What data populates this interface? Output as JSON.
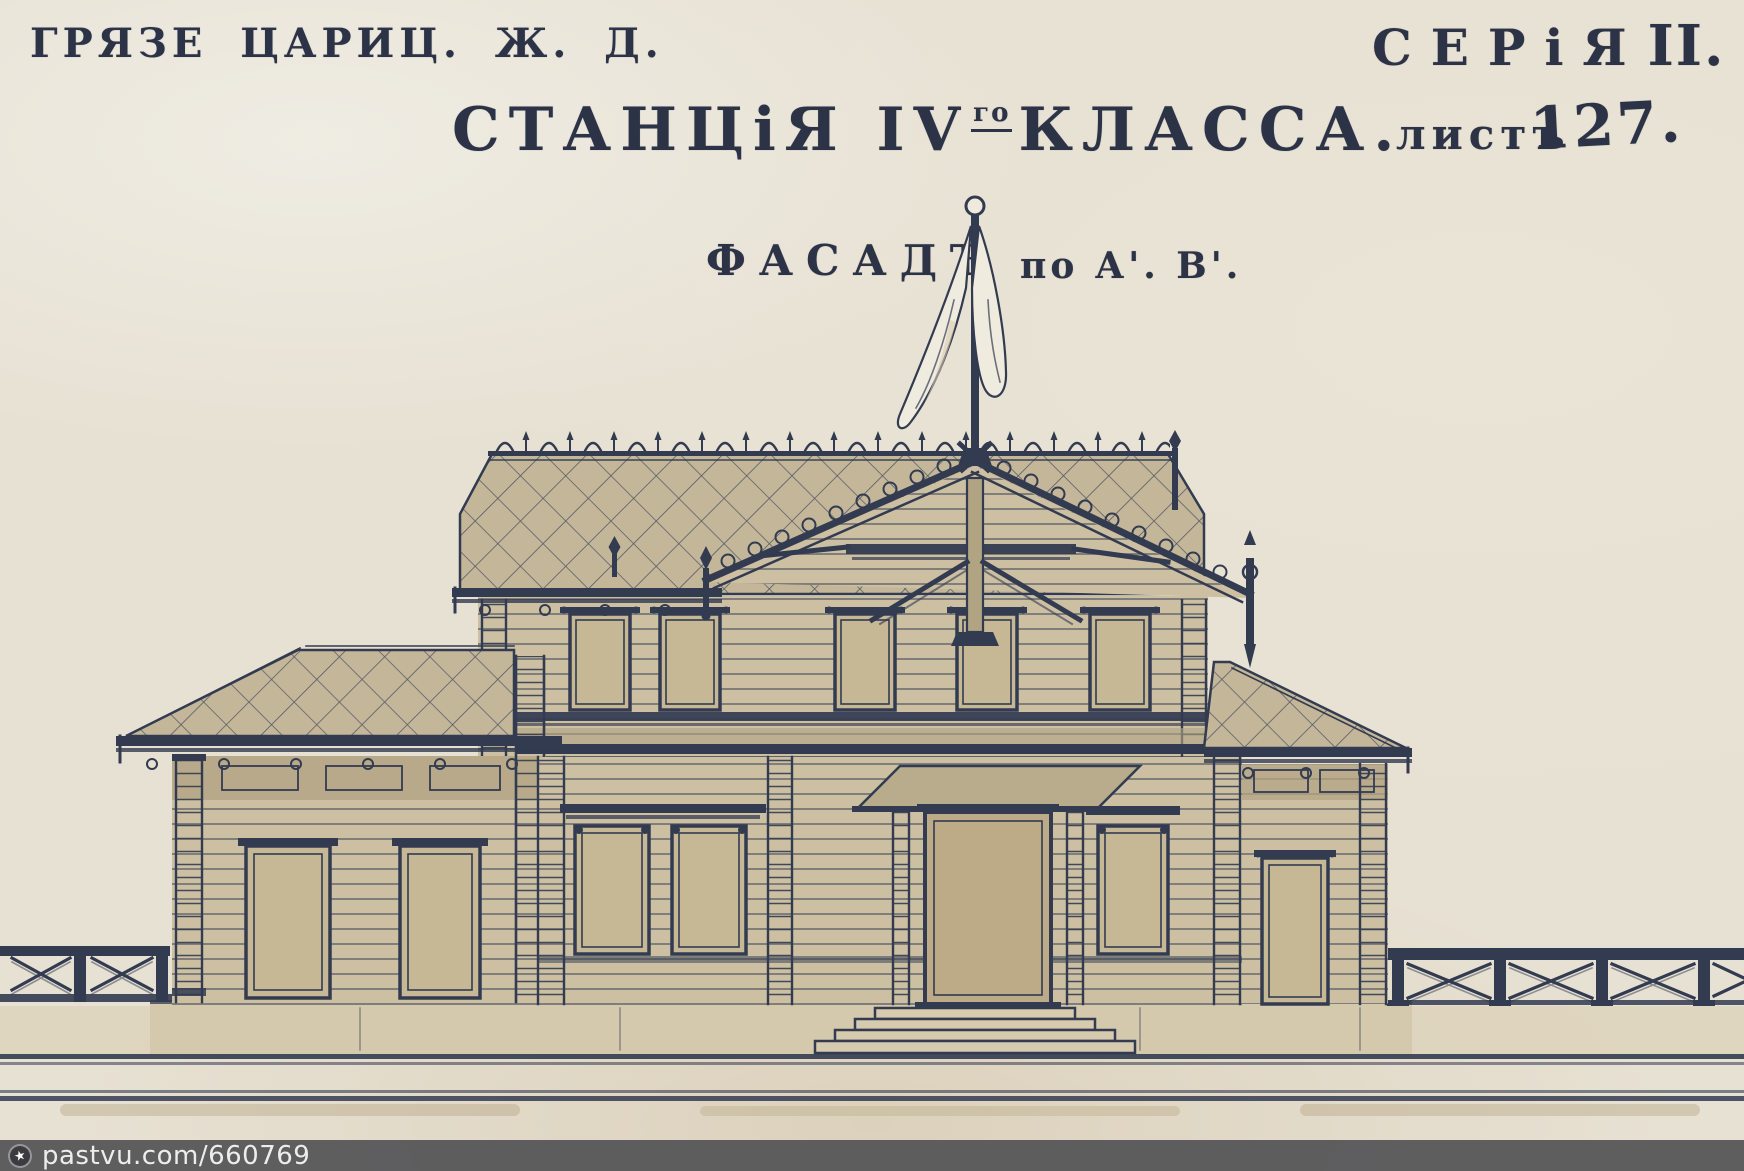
{
  "header": {
    "railway": "ГРЯЗЕ ЦАРИЦ. Ж. Д.",
    "series_word": "СЕРіЯ",
    "series_numeral": "II.",
    "title_station": "СТАНЦіЯ IV",
    "title_superscript": "го",
    "title_class": "КЛАССА.",
    "sheet_word": "листъ",
    "sheet_number": "127."
  },
  "caption": {
    "facade": "ФАСАДЪ",
    "axis": "по А'. В'."
  },
  "watermark": {
    "text": "pastvu.com/660769",
    "icon": "star-circle-icon",
    "star_glyph": "★"
  },
  "colors": {
    "paper": "#e7e1d3",
    "ink": "#323b50",
    "roof": "#c4b699",
    "wall": "#cdbfa2",
    "wall_shade": "#b1a483",
    "window_panel": "#c6b795",
    "watermark_bar": "#58585a"
  }
}
